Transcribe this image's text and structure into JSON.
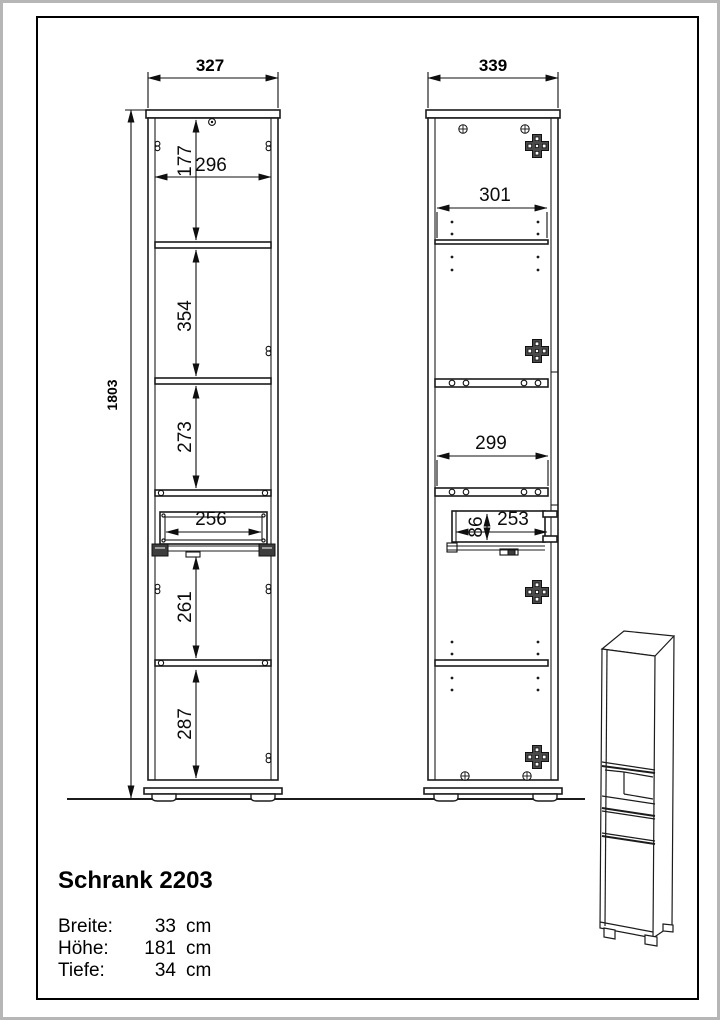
{
  "page": {
    "background": "#ffffff",
    "outer_border_color": "#b6b6b6",
    "frame_color": "#000000",
    "line_color": "#1c1c1c"
  },
  "front_view": {
    "width": "327",
    "height": "1803",
    "top_section_height": "177",
    "inner_width": "296",
    "middle_section_height": "354",
    "third_section_height": "273",
    "drawer_inner_width": "256",
    "fourth_section_height": "261",
    "bottom_section_height": "287"
  },
  "side_view": {
    "width": "339",
    "upper_inner_depth": "301",
    "lower_inner_depth": "299",
    "drawer_inner_height": "86",
    "drawer_inner_depth": "253"
  },
  "title_block": {
    "title": "Schrank 2203",
    "specs": [
      {
        "label": "Breite:",
        "value": "33",
        "unit": "cm"
      },
      {
        "label": "Höhe:",
        "value": "181",
        "unit": "cm"
      },
      {
        "label": "Tiefe:",
        "value": "34",
        "unit": "cm"
      }
    ]
  }
}
